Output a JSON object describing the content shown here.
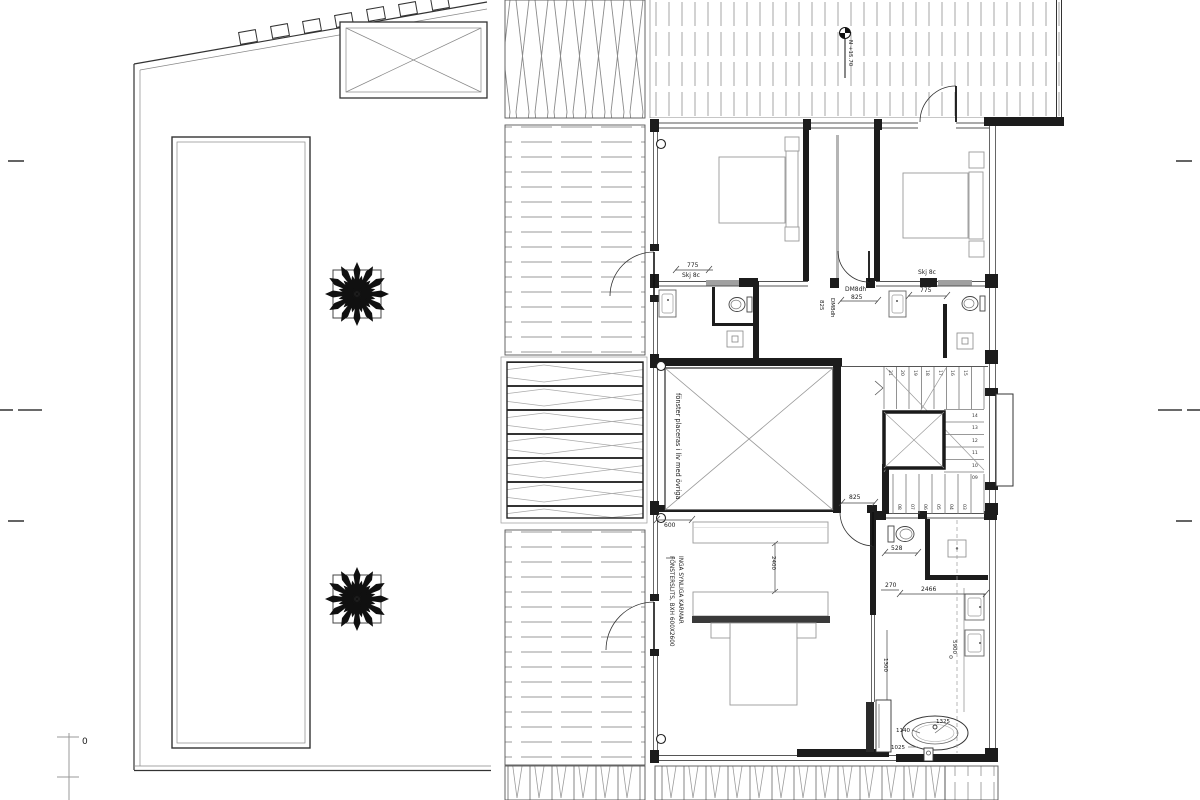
{
  "drawing": {
    "level_marker": "N +15.70",
    "scale_zero": "0",
    "notes": {
      "window_alignment": "fönster placeras i liv med övriga",
      "window_slit_line1": "FÖNSTERSLITS, BXH 600X2600",
      "window_slit_line2": "INGA SYNLIGA KARMAR"
    },
    "labels": {
      "sliding_door_left": "Skj 8c",
      "sliding_door_right": "Skj 8c",
      "door_dm8dh": "DM8dh",
      "door_dm8dh_rotated": "DM8dh"
    },
    "dimensions": {
      "bath_left_width": "775",
      "bath_right_width": "775",
      "corridor_door": "825",
      "hall_door": "825",
      "door_rotated": "825",
      "void_opening": "600",
      "bed_wall": "2400",
      "wc_offset": "528",
      "wall_offset": "270",
      "bath_width": "2466",
      "bath_length": "5900",
      "cabinet_depth": "1300",
      "tub_width": "1140",
      "tub_diameter": "1325",
      "tub_offset": "1025"
    },
    "stair": {
      "top_run": [
        "21",
        "20",
        "19",
        "18",
        "17",
        "16",
        "15"
      ],
      "right_run": [
        "14",
        "13",
        "12",
        "11",
        "10",
        "09"
      ],
      "bottom_run": [
        "08",
        "07",
        "06",
        "05",
        "04",
        "03"
      ]
    }
  }
}
